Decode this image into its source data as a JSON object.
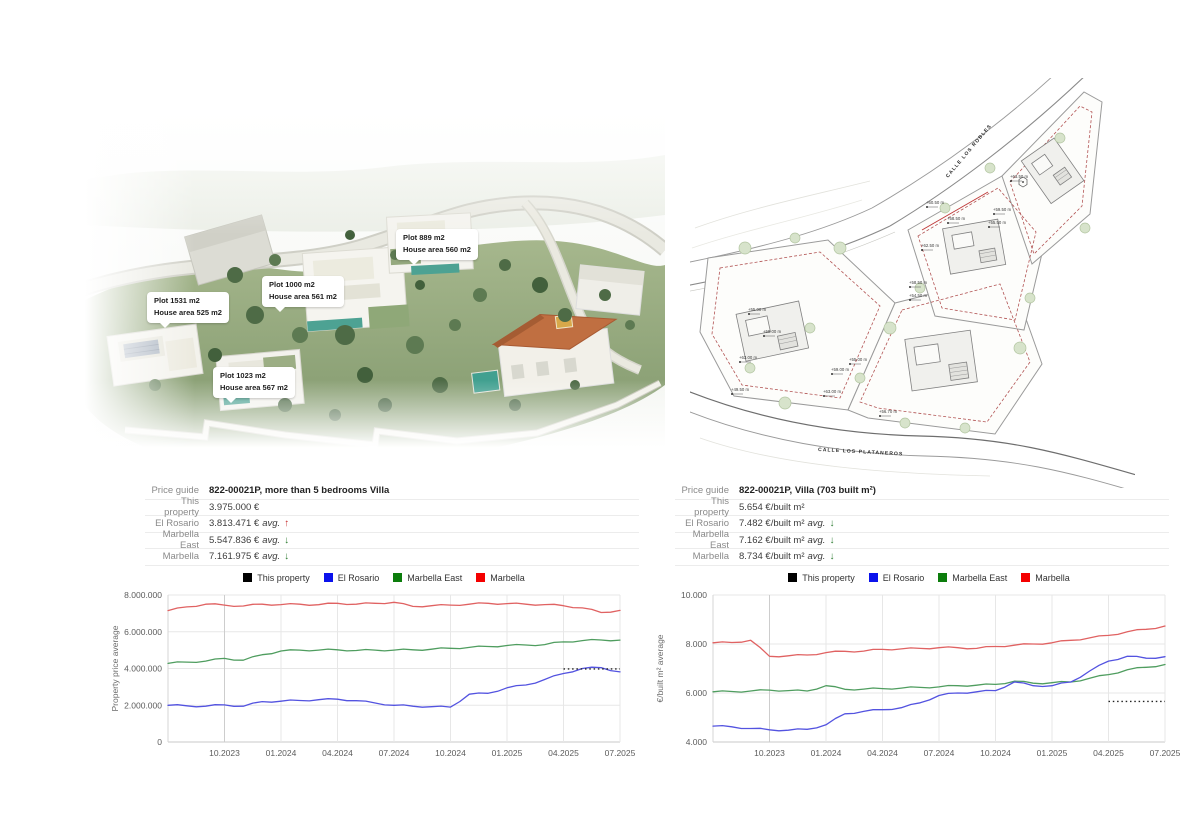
{
  "render": {
    "callouts": [
      {
        "line1": "Plot 1531 m2",
        "line2": "House area 525 m2"
      },
      {
        "line1": "Plot 1000 m2",
        "line2": "House area 561 m2"
      },
      {
        "line1": "Plot 889 m2",
        "line2": "House area 560 m2"
      },
      {
        "line1": "Plot 1023 m2",
        "line2": "House area 567 m2"
      }
    ]
  },
  "site_plan": {
    "street_top": "CALLE LOS ROBLES",
    "street_bottom": "CALLE LOS PLATANEROS",
    "elevation_labels": [
      {
        "t": "+63.50 m",
        "x": 320,
        "y": 100
      },
      {
        "t": "+60.50 m",
        "x": 236,
        "y": 126
      },
      {
        "t": "+59.50 m",
        "x": 303,
        "y": 133
      },
      {
        "t": "+55.50 m",
        "x": 298,
        "y": 146
      },
      {
        "t": "+58.50 m",
        "x": 257,
        "y": 142
      },
      {
        "t": "+62.50 m",
        "x": 231,
        "y": 169
      },
      {
        "t": "+58.50 m",
        "x": 219,
        "y": 206
      },
      {
        "t": "+54.50 m",
        "x": 219,
        "y": 219
      },
      {
        "t": "+55.00 m",
        "x": 58,
        "y": 233
      },
      {
        "t": "+59.00 m",
        "x": 73,
        "y": 255
      },
      {
        "t": "+63.00 m",
        "x": 49,
        "y": 281
      },
      {
        "t": "+49.50 m",
        "x": 41,
        "y": 313
      },
      {
        "t": "+55.00 m",
        "x": 159,
        "y": 283
      },
      {
        "t": "+59.00 m",
        "x": 141,
        "y": 293
      },
      {
        "t": "+63.00 m",
        "x": 133,
        "y": 315
      },
      {
        "t": "+56.70 m",
        "x": 189,
        "y": 335
      }
    ]
  },
  "panels": [
    {
      "table": {
        "rows": [
          {
            "label": "Price guide",
            "value": "822-00021P, more than 5 bedrooms Villa",
            "bold": true,
            "suffix": "",
            "arrow": "",
            "arrow_color": ""
          },
          {
            "label": "This property",
            "value": "3.975.000 €",
            "bold": false,
            "suffix": "",
            "arrow": "",
            "arrow_color": ""
          },
          {
            "label": "El Rosario",
            "value": "3.813.471 €",
            "bold": false,
            "suffix": "avg.",
            "arrow": "↑",
            "arrow_color": "#c62f2f"
          },
          {
            "label": "Marbella East",
            "value": "5.547.836 €",
            "bold": false,
            "suffix": "avg.",
            "arrow": "↓",
            "arrow_color": "#2e7d32"
          },
          {
            "label": "Marbella",
            "value": "7.161.975 €",
            "bold": false,
            "suffix": "avg.",
            "arrow": "↓",
            "arrow_color": "#2e7d32"
          }
        ]
      }
    },
    {
      "table": {
        "rows": [
          {
            "label": "Price guide",
            "value": "822-00021P, Villa (703 built m²)",
            "bold": true,
            "suffix": "",
            "arrow": "",
            "arrow_color": ""
          },
          {
            "label": "This property",
            "value": "5.654 €/built m²",
            "bold": false,
            "suffix": "",
            "arrow": "",
            "arrow_color": ""
          },
          {
            "label": "El Rosario",
            "value": "7.482 €/built m²",
            "bold": false,
            "suffix": "avg.",
            "arrow": "↓",
            "arrow_color": "#2e7d32"
          },
          {
            "label": "Marbella East",
            "value": "7.162 €/built m²",
            "bold": false,
            "suffix": "avg.",
            "arrow": "↓",
            "arrow_color": "#2e7d32"
          },
          {
            "label": "Marbella",
            "value": "8.734 €/built m²",
            "bold": false,
            "suffix": "avg.",
            "arrow": "↓",
            "arrow_color": "#2e7d32"
          }
        ]
      }
    }
  ],
  "chart_data": [
    {
      "type": "line",
      "title": "",
      "ylabel": "Property price average",
      "x": [
        "07.2023",
        "08.2023",
        "09.2023",
        "10.2023",
        "11.2023",
        "12.2023",
        "01.2024",
        "02.2024",
        "03.2024",
        "04.2024",
        "05.2024",
        "06.2024",
        "07.2024",
        "08.2024",
        "09.2024",
        "10.2024",
        "11.2024",
        "12.2024",
        "01.2025",
        "02.2025",
        "03.2025",
        "04.2025",
        "05.2025",
        "06.2025",
        "07.2025"
      ],
      "xticks": [
        {
          "i": 3,
          "label": "10.2023"
        },
        {
          "i": 6,
          "label": "01.2024"
        },
        {
          "i": 9,
          "label": "04.2024"
        },
        {
          "i": 12,
          "label": "07.2024"
        },
        {
          "i": 15,
          "label": "10.2024"
        },
        {
          "i": 18,
          "label": "01.2025"
        },
        {
          "i": 21,
          "label": "04.2025"
        },
        {
          "i": 24,
          "label": "07.2025"
        }
      ],
      "ylim": [
        0,
        8000000
      ],
      "yticks": [
        {
          "v": 0,
          "label": "0"
        },
        {
          "v": 2000000,
          "label": "2.000.000"
        },
        {
          "v": 4000000,
          "label": "4.000.000"
        },
        {
          "v": 6000000,
          "label": "6.000.000"
        },
        {
          "v": 8000000,
          "label": "8.000.000"
        }
      ],
      "grid": true,
      "legend_position": "top",
      "legend": [
        {
          "label": "This property",
          "color": "#000000"
        },
        {
          "label": "El Rosario",
          "color": "#0b12ec"
        },
        {
          "label": "Marbella East",
          "color": "#0c7d0c"
        },
        {
          "label": "Marbella",
          "color": "#f40000"
        }
      ],
      "series": [
        {
          "name": "Marbella",
          "color": "#e06262",
          "values": [
            7150000,
            7350000,
            7500000,
            7450000,
            7400000,
            7500000,
            7480000,
            7500000,
            7470000,
            7550000,
            7500000,
            7550000,
            7600000,
            7380000,
            7420000,
            7450000,
            7500000,
            7550000,
            7530000,
            7500000,
            7480000,
            7420000,
            7300000,
            7050000,
            7161975
          ]
        },
        {
          "name": "Marbella East",
          "color": "#4f9d5f",
          "values": [
            4280000,
            4350000,
            4400000,
            4550000,
            4450000,
            4750000,
            4950000,
            5000000,
            5000000,
            5020000,
            4980000,
            5000000,
            5000000,
            5020000,
            5050000,
            5100000,
            5150000,
            5200000,
            5250000,
            5280000,
            5300000,
            5450000,
            5520000,
            5550000,
            5547836
          ]
        },
        {
          "name": "El Rosario",
          "color": "#5353e0",
          "values": [
            2000000,
            1970000,
            1950000,
            2020000,
            1950000,
            2200000,
            2220000,
            2260000,
            2300000,
            2330000,
            2250000,
            2120000,
            2000000,
            1950000,
            1920000,
            1900000,
            2600000,
            2650000,
            2950000,
            3100000,
            3400000,
            3730000,
            4000000,
            4050000,
            3813471
          ]
        }
      ],
      "this_property": {
        "name": "This property",
        "value": 3975000,
        "from_index": 21,
        "color": "#222222"
      }
    },
    {
      "type": "line",
      "title": "",
      "ylabel": "€/built m² average",
      "x": [
        "07.2023",
        "08.2023",
        "09.2023",
        "10.2023",
        "11.2023",
        "12.2023",
        "01.2024",
        "02.2024",
        "03.2024",
        "04.2024",
        "05.2024",
        "06.2024",
        "07.2024",
        "08.2024",
        "09.2024",
        "10.2024",
        "11.2024",
        "12.2024",
        "01.2025",
        "02.2025",
        "03.2025",
        "04.2025",
        "05.2025",
        "06.2025",
        "07.2025"
      ],
      "xticks": [
        {
          "i": 3,
          "label": "10.2023"
        },
        {
          "i": 6,
          "label": "01.2024"
        },
        {
          "i": 9,
          "label": "04.2024"
        },
        {
          "i": 12,
          "label": "07.2024"
        },
        {
          "i": 15,
          "label": "10.2024"
        },
        {
          "i": 18,
          "label": "01.2025"
        },
        {
          "i": 21,
          "label": "04.2025"
        },
        {
          "i": 24,
          "label": "07.2025"
        }
      ],
      "ylim": [
        4000,
        10000
      ],
      "yticks": [
        {
          "v": 4000,
          "label": "4.000"
        },
        {
          "v": 6000,
          "label": "6.000"
        },
        {
          "v": 8000,
          "label": "8.000"
        },
        {
          "v": 10000,
          "label": "10.000"
        }
      ],
      "grid": true,
      "legend_position": "top",
      "legend": [
        {
          "label": "This property",
          "color": "#000000"
        },
        {
          "label": "El Rosario",
          "color": "#0b12ec"
        },
        {
          "label": "Marbella East",
          "color": "#0c7d0c"
        },
        {
          "label": "Marbella",
          "color": "#f40000"
        }
      ],
      "series": [
        {
          "name": "Marbella",
          "color": "#e06262",
          "values": [
            8050,
            8060,
            8150,
            7500,
            7520,
            7550,
            7650,
            7700,
            7710,
            7780,
            7800,
            7820,
            7850,
            7850,
            7820,
            7900,
            7950,
            8000,
            8050,
            8150,
            8250,
            8350,
            8500,
            8600,
            8734
          ]
        },
        {
          "name": "Marbella East",
          "color": "#4f9d5f",
          "values": [
            6050,
            6060,
            6080,
            6120,
            6100,
            6080,
            6300,
            6150,
            6160,
            6180,
            6200,
            6230,
            6250,
            6300,
            6320,
            6350,
            6480,
            6400,
            6420,
            6450,
            6600,
            6750,
            6950,
            7050,
            7162
          ]
        },
        {
          "name": "El Rosario",
          "color": "#5353e0",
          "values": [
            4650,
            4620,
            4550,
            4500,
            4480,
            4520,
            4700,
            5150,
            5250,
            5320,
            5400,
            5600,
            5900,
            6000,
            6050,
            6100,
            6450,
            6300,
            6300,
            6450,
            6900,
            7300,
            7500,
            7420,
            7482
          ]
        }
      ],
      "this_property": {
        "name": "This property",
        "value": 5654,
        "from_index": 21,
        "color": "#222222"
      }
    }
  ]
}
